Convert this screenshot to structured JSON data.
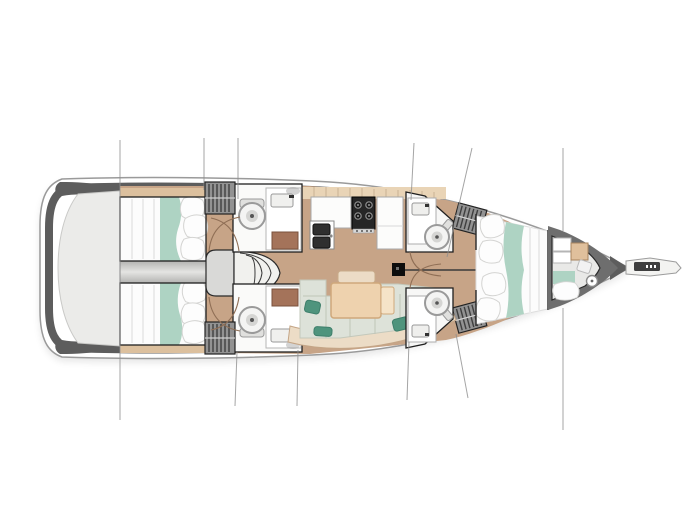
{
  "canvas": {
    "width": 690,
    "height": 518
  },
  "diagram": {
    "type": "sailing-yacht-interior-deck-plan",
    "orientation": "bow-right-stern-left",
    "features": [
      "hull",
      "swim-platform-transom",
      "rigging-stay-lines",
      "bowsprit",
      "port-aft-cabin-double-berth",
      "starboard-aft-cabin-double-berth",
      "engine-compartment-divider",
      "companionway-steps",
      "port-aft-head-toilet-sink",
      "starboard-aft-head-toilet-sink",
      "hanging-lockers",
      "galley-double-sink",
      "galley-stove",
      "galley-counters",
      "mast",
      "saloon-settee",
      "saloon-table",
      "saloon-cushions",
      "accent-pillows",
      "port-forward-head-toilet-sink",
      "starboard-forward-head-toilet-sink",
      "port-forward-cabin-berth",
      "starboard-forward-cabin-berth",
      "bow-crew-cabin",
      "bow-cabin-berth",
      "bow-cabin-toilet",
      "door-swing-arcs",
      "wood-cabinets"
    ]
  },
  "colors": {
    "background": "#ffffff",
    "hull_rim": "#5d5d5d",
    "hull_stroke": "#9a9a9a",
    "hull_fill": "#ffffff",
    "transom": "#ebebe9",
    "floor": "#c7a487",
    "shelf": "#dcc09e",
    "tiles": "#e9d4b6",
    "wood": "#a4735a",
    "bed_white": "#fcfcfc",
    "bedding_teal": "#aed3c3",
    "cushion_sage": "#dde2d9",
    "pillow_teal": "#4f947d",
    "table": "#eed2ae",
    "table_flap": "#f5e3c8",
    "settee": "#ecdcc6",
    "appliance_dark": "#262626",
    "locker_grey": "#929292",
    "step_grey": "#d9d9d7",
    "divider_grey": "#cfcfcd",
    "outline": "#1f1f1f",
    "rigging": "#8e8e8e",
    "bow_wall": "#6e6e6e"
  }
}
